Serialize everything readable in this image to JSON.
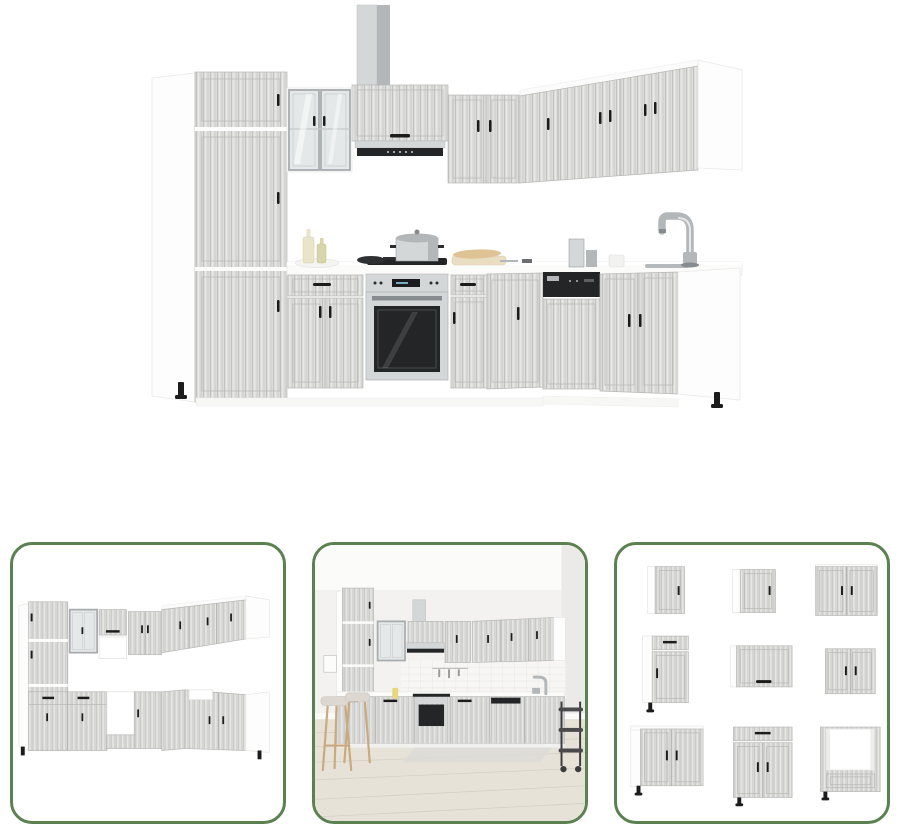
{
  "page": {
    "title": "Kitchen cabinet set product image gallery",
    "background": "#ffffff"
  },
  "gallery": {
    "main_image": {
      "name": "kitchen-set-main-view",
      "description": "L-shaped kitchen cabinet set in concrete grey wood grain with built-in oven, hob with pot, extractor hood with chimney duct, sink base with tall chrome faucet, black bow handles and white carcasses"
    },
    "thumbnails": [
      {
        "name": "kitchen-set-alternate-angle",
        "description": "Same L-shaped kitchen set seen from the opposite angle without appliances, showing open niches for oven and sink"
      },
      {
        "name": "kitchen-set-room-scene",
        "description": "Kitchen set staged in a room with white tiled splashback, light wood plank floor, two bar stools and a dark serving trolley"
      },
      {
        "name": "cabinet-units-grid",
        "description": "Grid of nine individual cabinet units: wall cabinets, flap cabinet, drawer base cabinets, double-door base cabinet and oven housing cabinet"
      }
    ]
  },
  "colors": {
    "page_bg": "#ffffff",
    "thumb_border": "#5b8150",
    "cabinet_base": "#dcdcda",
    "grain_dark": "#c2c2c0",
    "grain_mid": "#cfcfcd",
    "grain_light": "#ebebe9",
    "door_line": "#b7b7b5",
    "carcass": "#fdfdfd",
    "carcass_edge": "#e9e9e7",
    "handle": "#1c1c1c",
    "steel_light": "#d4d7d8",
    "steel": "#b3b7b9",
    "steel_dark": "#868c8f",
    "appliance_dark": "#232526",
    "glass": "#e4e8e9",
    "glass_frame": "#a8acae",
    "counter": "#fbfbfa",
    "counter_edge": "#e9e9e7",
    "bottle_cream": "#eae4c9",
    "bottle_olive": "#d8d5aa",
    "board_tan": "#e9ddc2",
    "baguette": "#dfc394",
    "wall": "#f3f2f0",
    "tile_line": "#e6e5e2",
    "floor": "#e7e2d8",
    "floor_line": "#d6cfc3",
    "mat": "#dbdbd7",
    "stool_wood": "#c9a97d",
    "stool_seat": "#dcd7d0",
    "cart_dark": "#3c3c3e"
  }
}
